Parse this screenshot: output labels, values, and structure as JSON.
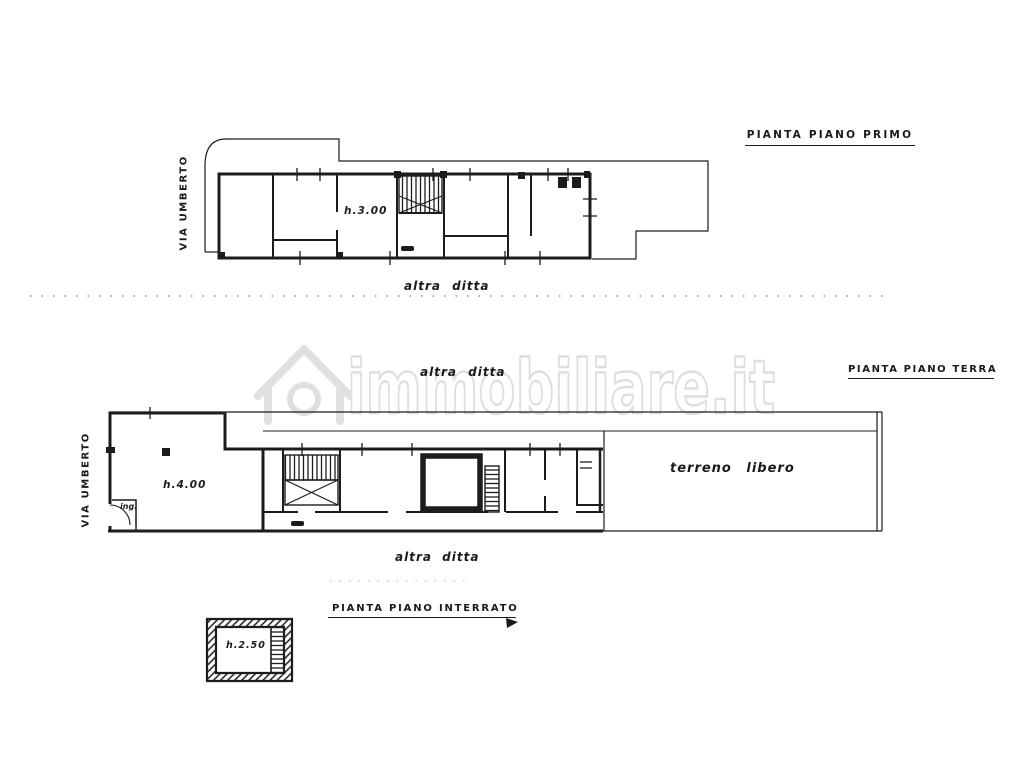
{
  "page": {
    "background": "#ffffff",
    "ink_color": "#1c1c1c",
    "watermark_color": "#e0e0e0",
    "kind": "scanned cadastral floor plan drawing"
  },
  "watermark": {
    "icon": "house-logo-icon",
    "text": "immobiliare.it"
  },
  "plans": {
    "first_floor": {
      "title": "PIANTA PIANO PRIMO",
      "street_label": "VIA UMBERTO",
      "room_height": "h.3.00",
      "boundary_label": "altra ditta"
    },
    "ground_floor": {
      "title": "PIANTA PIANO TERRA",
      "street_label": "VIA UMBERTO",
      "room_height": "h.4.00",
      "entrance_label": "ing.",
      "open_land_label": "terreno libero",
      "boundary_label_top": "altra ditta",
      "boundary_label_bottom": "altra ditta"
    },
    "basement": {
      "title": "PIANTA PIANO INTERRATO",
      "room_height": "h.2.50"
    }
  }
}
